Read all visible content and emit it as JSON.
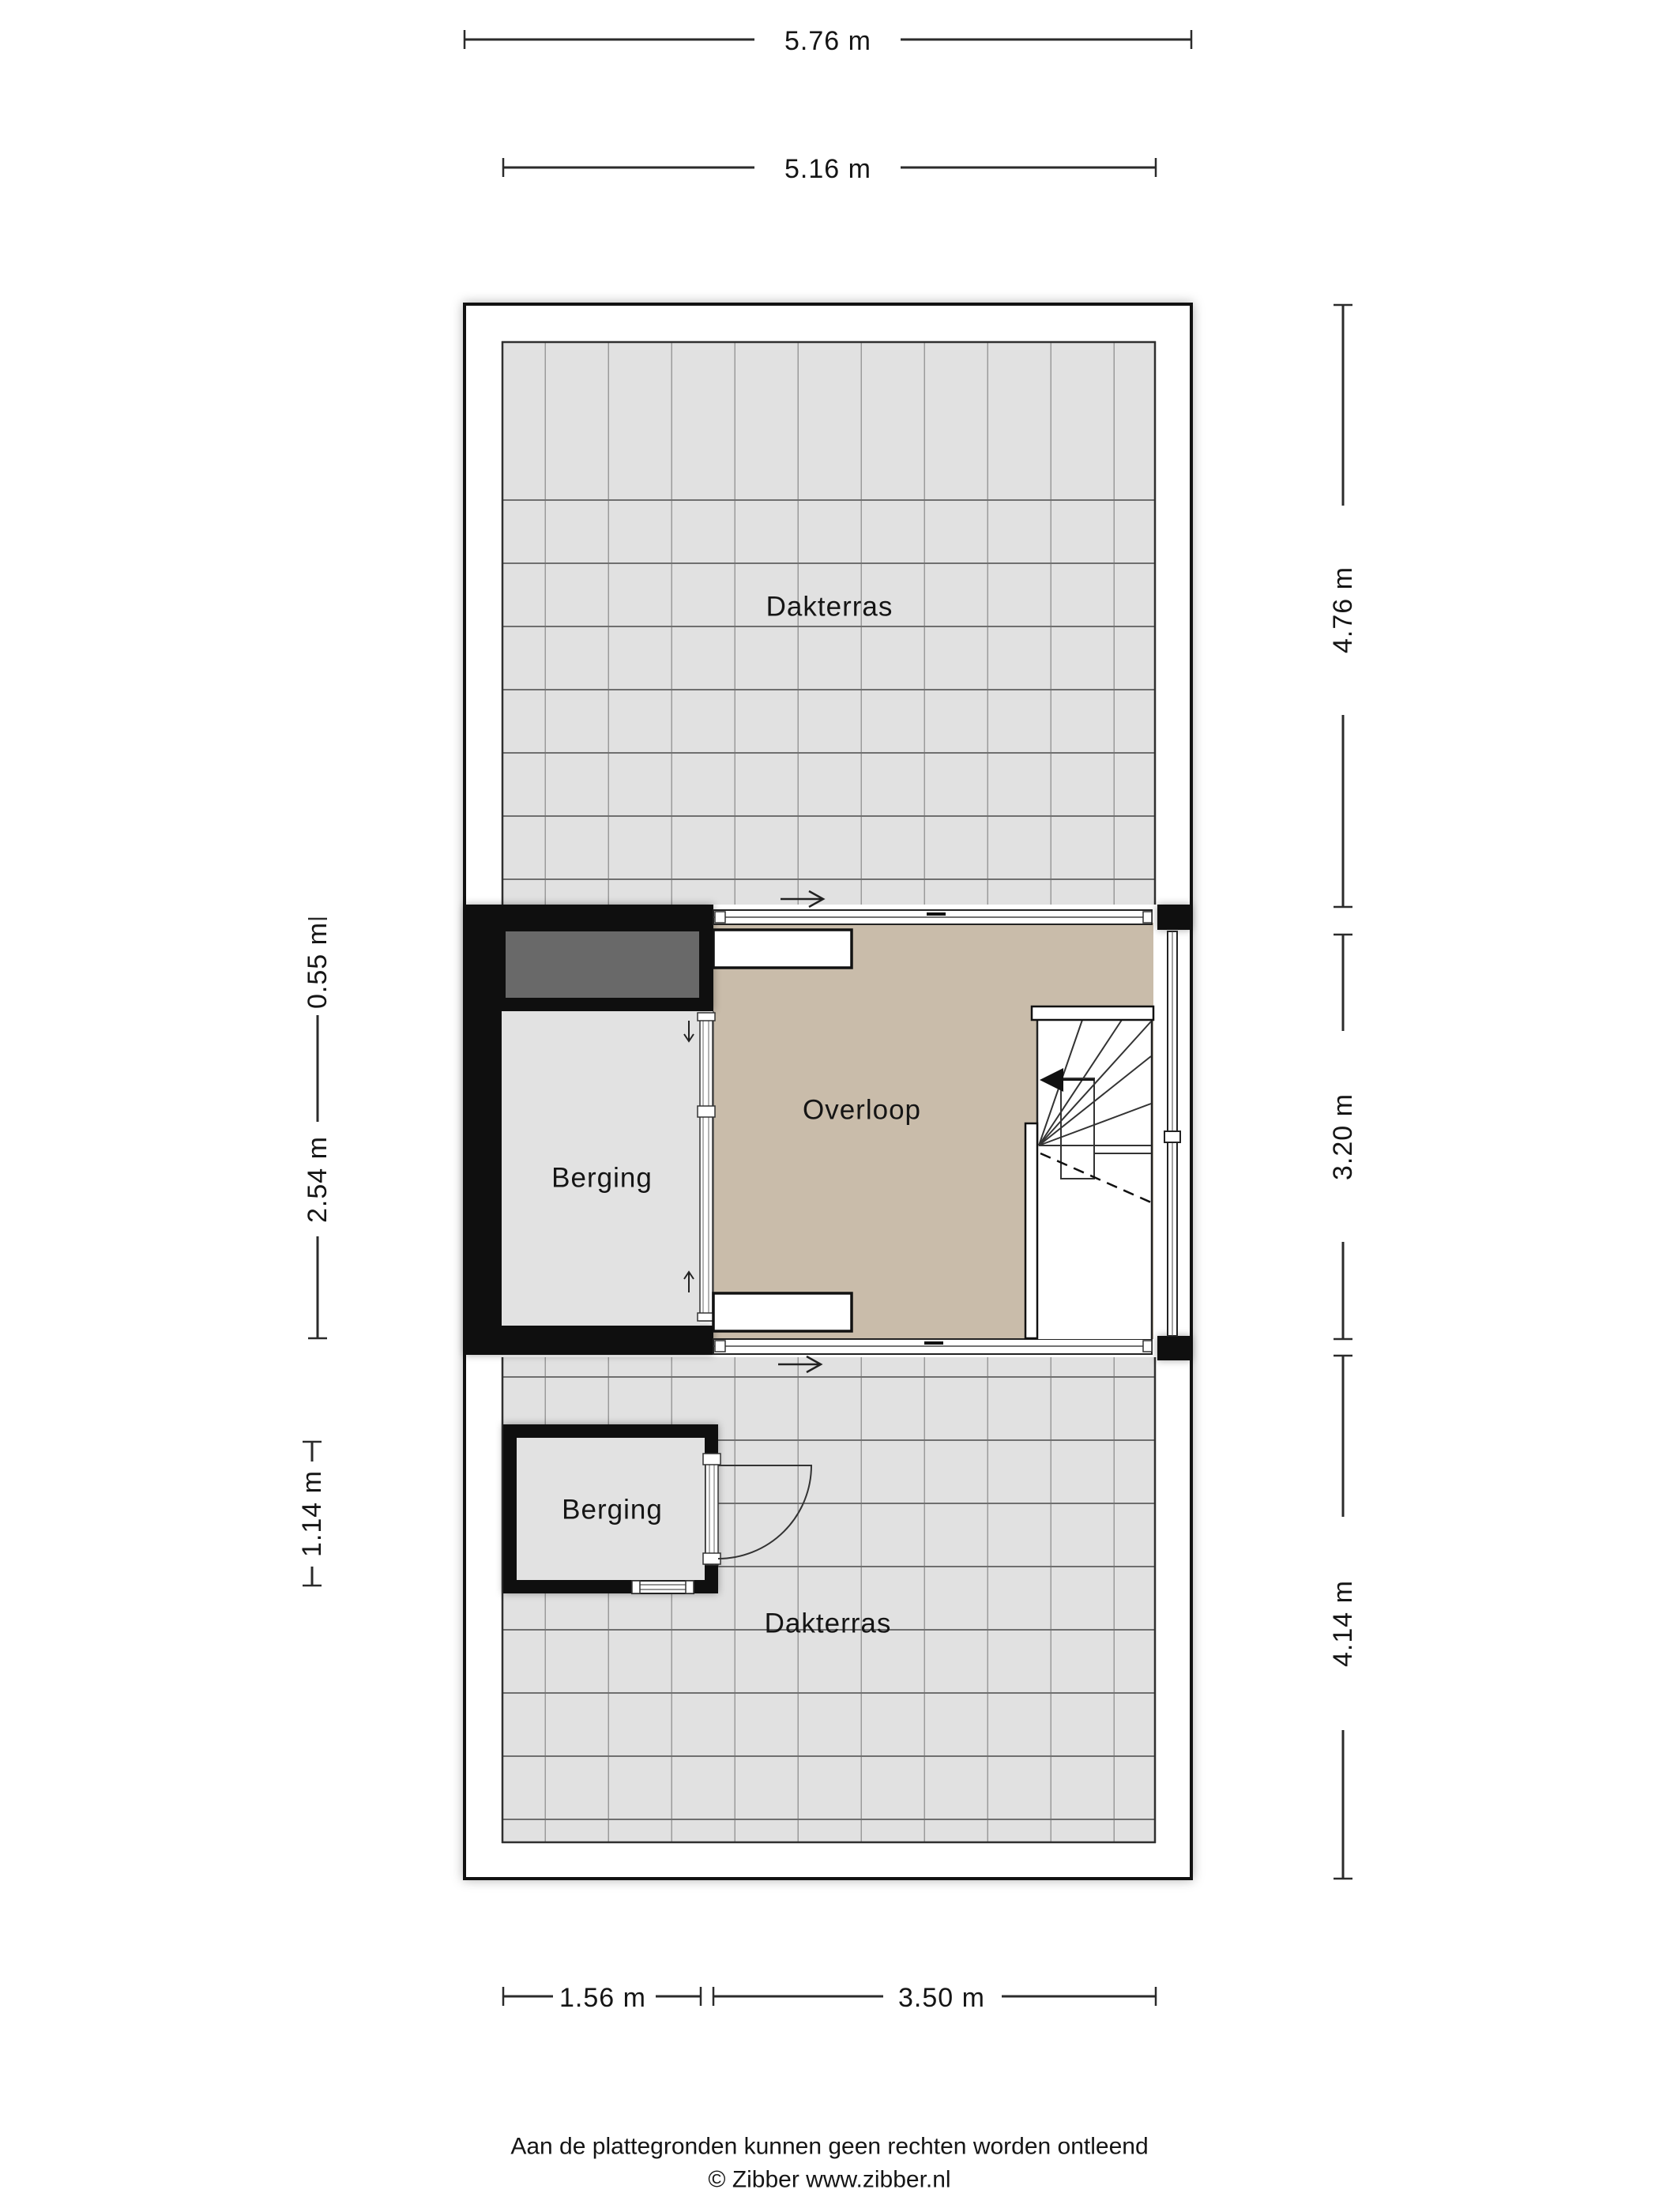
{
  "plan": {
    "rooms": {
      "dakterras_top": "Dakterras",
      "overloop": "Overloop",
      "berging_middle": "Berging",
      "berging_bottom": "Berging",
      "dakterras_bottom": "Dakterras"
    },
    "dimensions": {
      "top_outer": "5.76 m",
      "top_inner": "5.16 m",
      "right_top": "4.76 m",
      "right_middle": "3.20 m",
      "right_bottom": "4.14 m",
      "left_top": "0.55 m",
      "left_middle": "2.54 m",
      "left_bottom": "1.14 m",
      "bottom_left": "1.56 m",
      "bottom_right": "3.50 m"
    },
    "colors": {
      "wall": "#0f0f0f",
      "tile_floor": "#e1e1e1",
      "landing_floor": "#c9bcaa",
      "roof_element": "#696969"
    }
  },
  "footer": {
    "disclaimer": "Aan de plattegronden kunnen geen rechten worden ontleend",
    "credit": "© Zibber www.zibber.nl"
  }
}
